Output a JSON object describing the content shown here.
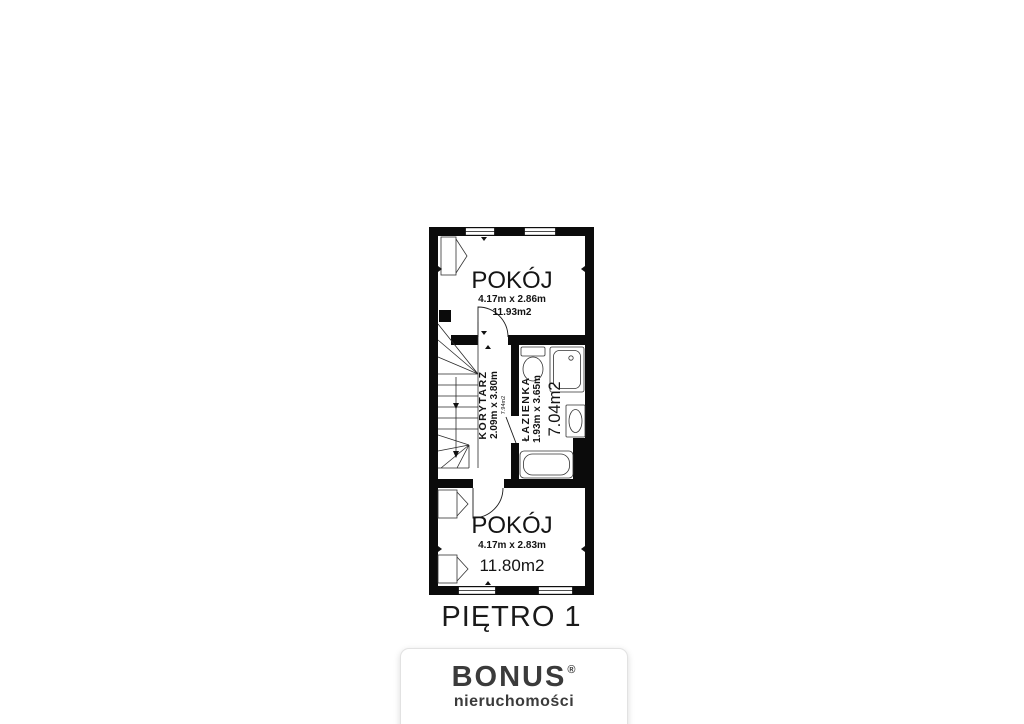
{
  "page": {
    "background_color": "#ffffff"
  },
  "floor_plan": {
    "floor_label": "PIĘTRO 1",
    "wall_color": "#0b0b0b",
    "rooms": {
      "room_top": {
        "name": "POKÓJ",
        "dimensions": "4.17m x 2.86m",
        "area": "11.93m2"
      },
      "corridor": {
        "name": "KORYTARZ",
        "dimensions": "2.09m x 3.80m",
        "area": "7.94m2"
      },
      "bathroom": {
        "name": "ŁAZIENKA",
        "dimensions": "1.93m x 3.65m",
        "area": "7.04m2"
      },
      "room_bottom": {
        "name": "POKÓJ",
        "dimensions": "4.17m x 2.83m",
        "area": "11.80m2"
      }
    }
  },
  "logo": {
    "brand": "BONUS",
    "registered_mark": "®",
    "subtitle": "nieruchomości",
    "text_color": "#3b3b3b"
  }
}
